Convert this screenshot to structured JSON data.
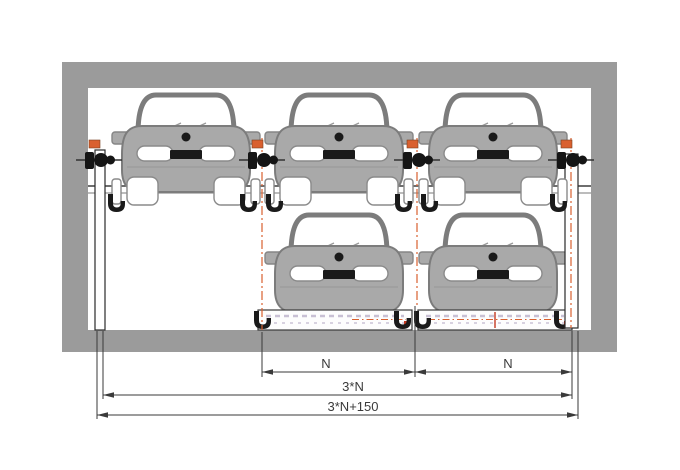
{
  "diagram": {
    "upper_level_cars": 3,
    "lower_level_cars": 2,
    "levels": 2
  },
  "dimensions": {
    "bay_width_left": "N",
    "bay_width_right": "N",
    "platform_total_width": "3*N",
    "overall_width": "3*N+150"
  },
  "colors": {
    "bg": "#ffffff",
    "wall": "#9b9b9b",
    "carBody": "#a9a9a9",
    "carOutline": "#7c7c7c",
    "dark": "#1a1a1a",
    "accent": "#d9602f",
    "red": "#c43a22",
    "hatch": "#c8c0d4",
    "dim": "#3a3a3a"
  }
}
